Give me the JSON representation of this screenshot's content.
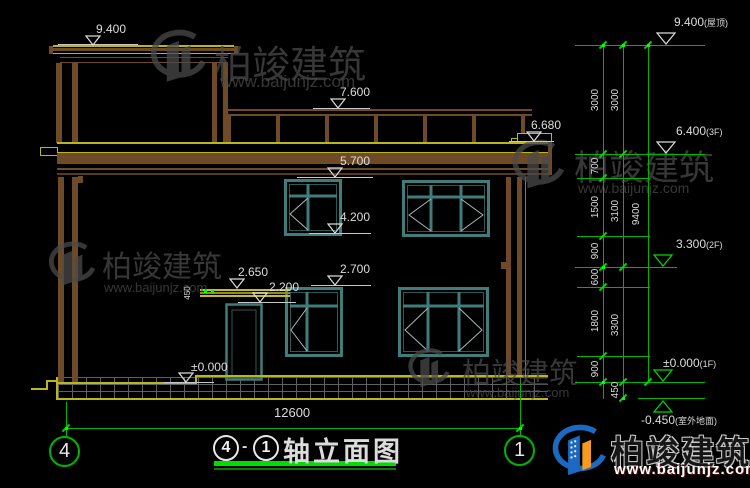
{
  "watermarks": {
    "brand": "柏竣建筑",
    "url": "www.baijunjz.com"
  },
  "logo": {
    "brand": "柏竣建筑",
    "url": "www.baijunjz.com"
  },
  "title_bar": {
    "axis_from": "4",
    "axis_to": "1",
    "separator": "-",
    "title": "轴立面图"
  },
  "grid": {
    "left": "4",
    "right": "1"
  },
  "dims": {
    "overall_width": "12600",
    "canopy": "450",
    "chain_inner": [
      "3000",
      "700",
      "1500",
      "900",
      "600",
      "1800",
      "900"
    ],
    "chain_mid": [
      "3000",
      "3100",
      "3300",
      "450"
    ],
    "chain_total": "9400"
  },
  "levels_left": [
    {
      "label": "9.400"
    },
    {
      "label": "7.600"
    },
    {
      "label": "6.680"
    },
    {
      "label": "5.700"
    },
    {
      "label": "4.200"
    },
    {
      "label": "2.700"
    },
    {
      "label": "2.650"
    },
    {
      "label": "2.200"
    },
    {
      "label": "±0.000"
    }
  ],
  "levels_right": [
    {
      "value": "9.400",
      "suffix": "(屋顶)"
    },
    {
      "value": "6.400",
      "suffix": "(3F)"
    },
    {
      "value": "3.300",
      "suffix": "(2F)"
    },
    {
      "value": "±0.000",
      "suffix": "(1F)"
    },
    {
      "value": "-0.450",
      "suffix": "(室外地面)"
    }
  ],
  "colors": {
    "dim_green": "#00b400",
    "trim_yellow": "#b8b81e",
    "wall_brown": "#6f4a28",
    "window_teal": "#3f7d7b",
    "logo_blue": "#1b69c0",
    "logo_orange": "#f59b22"
  }
}
